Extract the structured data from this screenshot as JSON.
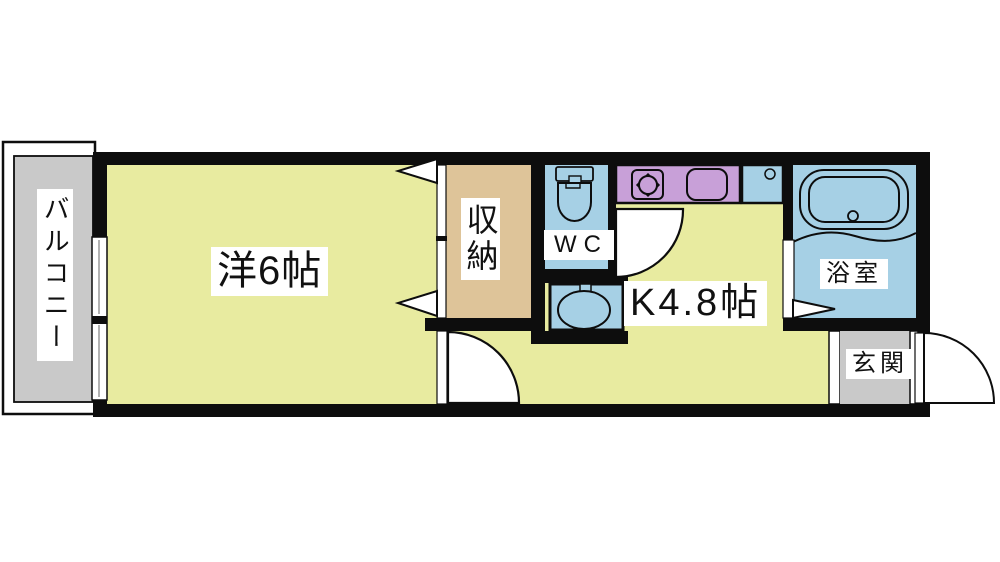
{
  "floor_plan": {
    "labels": {
      "balcony": "バルコニー",
      "western_room": "洋6帖",
      "closet": "収納",
      "wc": "WC",
      "kitchen": "K4.8帖",
      "bathroom": "浴室",
      "entrance": "玄関"
    },
    "colors": {
      "wall": "#0d0d0d",
      "floor_main": "#e8eba0",
      "closet_floor": "#dec499",
      "wet_area": "#a6d0e5",
      "kitchen_counter": "#c8a0d8",
      "balcony_entrance_gray": "#c9c9c9",
      "label_background": "#ffffff"
    }
  }
}
